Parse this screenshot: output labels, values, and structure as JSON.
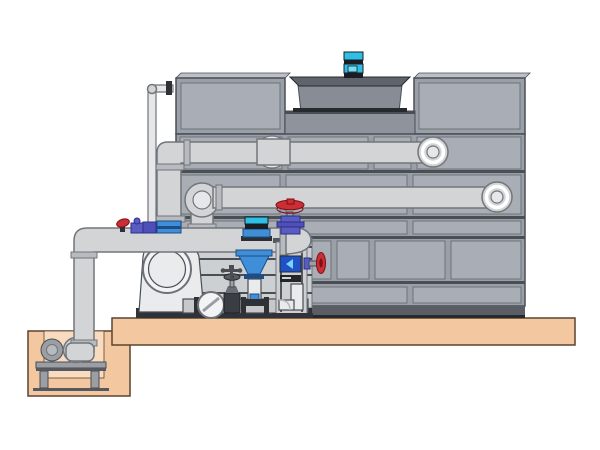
{
  "meta": {
    "alt_text": "Technical illustration: cooling tower casing with fan motor, external distribution piping, condenser pump skid with valves, and a sump pit pump on a concrete base",
    "width_px": 600,
    "height_px": 450
  },
  "colors": {
    "bg": "#ffffff",
    "tower-face": "#9aa0a8",
    "panel": "#a9aeb6",
    "panel-line": "#6e7278",
    "line-dark": "#4a4e55",
    "line-darkest": "#26292e",
    "bevel": "#bdc1c7",
    "wall": "#8f939b",
    "cowl": "#888c94",
    "cowl-dark": "#5f636b",
    "motor-cyan": "#2fbfe6",
    "motor-cyan-bright": "#74e0f6",
    "motor-dark": "#1a1d22",
    "pipe": "#d2d4d6",
    "pipe-light": "#e6e7e9",
    "pipe-dk": "#c6c8ca",
    "pipe-line": "#72767a",
    "collar": "#b7babe",
    "flange-dark": "#2e3136",
    "ring-white": "#ffffff",
    "valve-red": "#cb2e35",
    "valve-red-dark": "#7e1014",
    "valve-purple": "#5a5cc0",
    "valve-purple2": "#4e50b8",
    "valve-purple-dark": "#2c2e90",
    "equip-blue": "#3f8fd8",
    "equip-blue-dark": "#1e4d86",
    "gauge-blue": "#1f52c8",
    "gauge-arrow": "#7ad4f0",
    "backdrop": "#cdd0d3",
    "base-strip": "#2f3236",
    "band": "#5a5e64",
    "steel": "#9b9ea2",
    "steel-dark": "#55585e",
    "pump-white": "#eaebec",
    "pump-face": "#f2f3f4",
    "base-tan": "#f3c7a0",
    "base-tan-light": "#f9dcc0",
    "base-line": "#5a4330"
  },
  "components": [
    {
      "name": "cooling-tower",
      "desc": "gray paneled cooling tower casing"
    },
    {
      "name": "fan-cowl",
      "desc": "recessed fan cylinder on tower roof"
    },
    {
      "name": "fan-motor",
      "desc": "cyan fan motor on top of cowl"
    },
    {
      "name": "upper-distribution-pipe",
      "desc": "upper horizontal pipe with left riser elbow and flanged end"
    },
    {
      "name": "lower-distribution-pipe",
      "desc": "second horizontal pipe with flanged elbow ends"
    },
    {
      "name": "makeup-water-pipe",
      "desc": "thin vertical pipe entering tower top left"
    },
    {
      "name": "suction-header",
      "desc": "large pipe from sump elbow to domed cap"
    },
    {
      "name": "end-suction-pump",
      "desc": "pump housing with round suction face"
    },
    {
      "name": "inline-pump",
      "desc": "blue vertical inline pump / diffuser cone"
    },
    {
      "name": "globe-valve",
      "desc": "red handwheel valve on domed cap"
    },
    {
      "name": "check-valve",
      "desc": "round check valve on discharge pipe"
    },
    {
      "name": "gate-valve",
      "desc": "small gate valve on discharge pipe"
    },
    {
      "name": "riser-column",
      "desc": "framed riser column with blue gauge and inner elbow"
    },
    {
      "name": "column-valve",
      "desc": "red handwheel valve at column side"
    },
    {
      "name": "ground-platform",
      "desc": "tan concrete base slab"
    },
    {
      "name": "sump-pit",
      "desc": "tan sump pit with small horizontal pump on stand"
    }
  ]
}
